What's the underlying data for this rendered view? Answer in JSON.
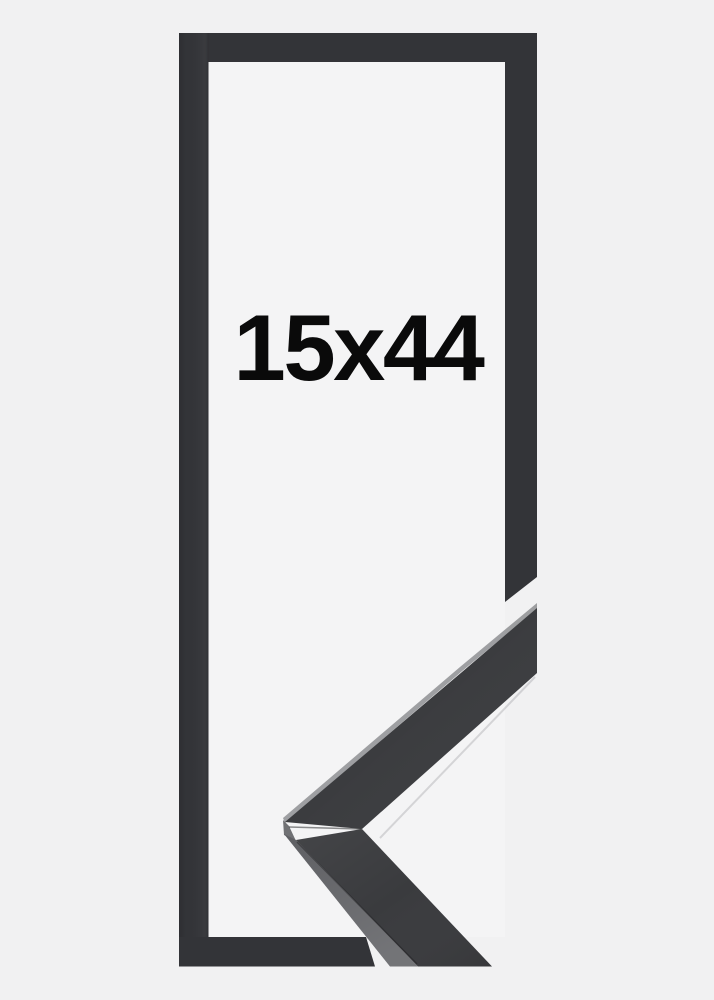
{
  "product": {
    "size_label": "15x44"
  },
  "colors": {
    "background": "#f1f1f2",
    "inner_background": "#f4f4f5",
    "frame": "#333438",
    "moulding_face": "#3b3c3f",
    "moulding_face_lower": "#3a3b3e",
    "moulding_side": "#58595d",
    "text": "#0a0a0a"
  }
}
